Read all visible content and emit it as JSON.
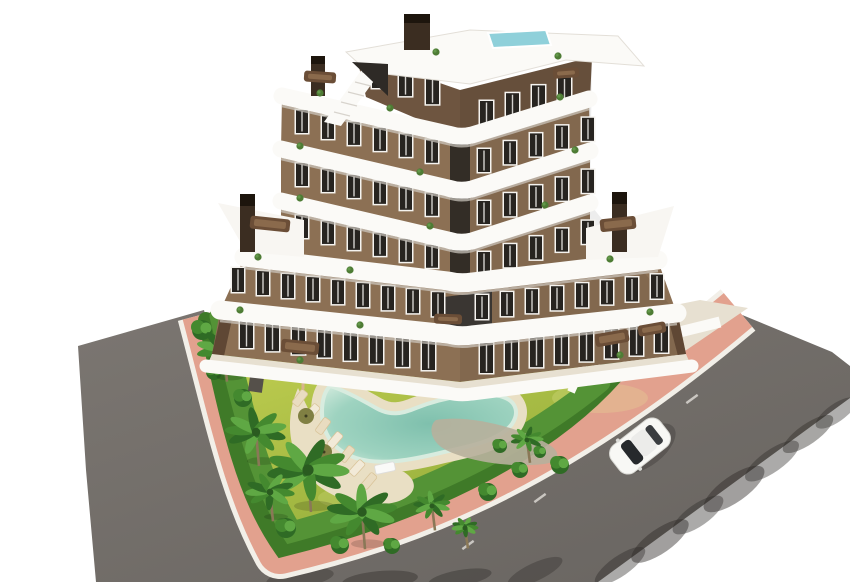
{
  "meta": {
    "scene_type": "aerial 3D architectural rendering",
    "subject": "modern apartment building with curved white balconies, pool garden, palm trees, corner plot with roads"
  },
  "colors": {
    "background": "#ffffff",
    "road": "#6f6a66",
    "road_light": "#7d7873",
    "sidewalk_pink": "#e2a18e",
    "curb_white": "#f2efe8",
    "lawn_light": "#c0cd4f",
    "lawn_dark": "#96af3c",
    "hedge_dark": "#3f7a28",
    "hedge_light": "#549336",
    "sand": "#e9dfc4",
    "gravel": "#b7b09c",
    "pool_deep": "#7fc0ad",
    "pool_shallow": "#cde8da",
    "facade": "#8c7054",
    "facade_dark": "#6e5540",
    "facade_side": "#5f4734",
    "band_white": "#fbfaf7",
    "band_shadow": "#cfcac2",
    "window_dark": "#272420",
    "window_frame": "#f5f3ef",
    "patio": "#e7e0d1",
    "chimney": "#3b2d21",
    "chimney_cap": "#1d150d",
    "roof_pool": "#8fd0da",
    "car_body": "#f8f8f5",
    "car_glass": "#26292c",
    "palm_dark": "#2f6b25",
    "palm_mid": "#44892f",
    "palm_light": "#5fa844",
    "trunk": "#8a7857",
    "furniture": "#6b4e37",
    "umbrella": "#7a7a3c",
    "courtyard_dark": "#3a3632"
  },
  "building": {
    "floors": 7,
    "window_rows": [
      {
        "x": 372,
        "y": 62,
        "slope": 0.3,
        "n": 3,
        "dx": 27,
        "w": 13,
        "h": 26
      },
      {
        "x": 480,
        "y": 101,
        "slope": -0.3,
        "n": 4,
        "dx": 26,
        "w": 13,
        "h": 26
      },
      {
        "x": 296,
        "y": 110,
        "slope": 0.229,
        "n": 6,
        "dx": 26,
        "w": 12,
        "h": 23
      },
      {
        "x": 478,
        "y": 149,
        "slope": -0.3,
        "n": 5,
        "dx": 26,
        "w": 12,
        "h": 23
      },
      {
        "x": 296,
        "y": 163,
        "slope": 0.229,
        "n": 6,
        "dx": 26,
        "w": 12,
        "h": 23
      },
      {
        "x": 478,
        "y": 201,
        "slope": -0.3,
        "n": 5,
        "dx": 26,
        "w": 12,
        "h": 23
      },
      {
        "x": 296,
        "y": 215,
        "slope": 0.229,
        "n": 6,
        "dx": 26,
        "w": 12,
        "h": 23
      },
      {
        "x": 478,
        "y": 252,
        "slope": -0.3,
        "n": 5,
        "dx": 26,
        "w": 12,
        "h": 23
      },
      {
        "x": 232,
        "y": 268,
        "slope": 0.121,
        "n": 9,
        "dx": 25,
        "w": 12,
        "h": 24
      },
      {
        "x": 476,
        "y": 295,
        "slope": -0.117,
        "n": 8,
        "dx": 25,
        "w": 12,
        "h": 24
      },
      {
        "x": 240,
        "y": 318,
        "slope": 0.121,
        "n": 8,
        "dx": 26,
        "w": 13,
        "h": 30
      },
      {
        "x": 480,
        "y": 343,
        "slope": -0.117,
        "n": 8,
        "dx": 25,
        "w": 13,
        "h": 30
      }
    ],
    "balcony_plants": [
      [
        320,
        93
      ],
      [
        390,
        108
      ],
      [
        560,
        97
      ],
      [
        300,
        146
      ],
      [
        420,
        172
      ],
      [
        575,
        150
      ],
      [
        300,
        198
      ],
      [
        430,
        226
      ],
      [
        545,
        205
      ],
      [
        258,
        257
      ],
      [
        350,
        270
      ],
      [
        610,
        259
      ],
      [
        240,
        310
      ],
      [
        360,
        325
      ],
      [
        650,
        312
      ],
      [
        300,
        360
      ],
      [
        620,
        355
      ],
      [
        436,
        52
      ],
      [
        558,
        56
      ]
    ],
    "furniture": [
      [
        270,
        224,
        40,
        13,
        6
      ],
      [
        618,
        224,
        36,
        13,
        -6
      ],
      [
        320,
        77,
        32,
        11,
        4
      ],
      [
        566,
        73,
        26,
        10,
        -4
      ],
      [
        300,
        347,
        38,
        13,
        6
      ],
      [
        612,
        338,
        34,
        13,
        -10
      ],
      [
        652,
        329,
        28,
        11,
        -10
      ],
      [
        448,
        319,
        28,
        10,
        2
      ]
    ]
  },
  "garden": {
    "palms": [
      {
        "x": 224,
        "y": 350,
        "r": 27
      },
      {
        "x": 256,
        "y": 432,
        "r": 30
      },
      {
        "x": 308,
        "y": 470,
        "r": 40
      },
      {
        "x": 362,
        "y": 512,
        "r": 34
      },
      {
        "x": 270,
        "y": 492,
        "r": 24
      },
      {
        "x": 416,
        "y": 302,
        "r": 44
      },
      {
        "x": 522,
        "y": 306,
        "r": 22
      },
      {
        "x": 527,
        "y": 440,
        "r": 16
      },
      {
        "x": 432,
        "y": 506,
        "r": 18
      },
      {
        "x": 465,
        "y": 528,
        "r": 13
      }
    ],
    "bushes": [
      [
        202,
        330,
        10
      ],
      [
        214,
        372,
        8
      ],
      [
        243,
        398,
        9
      ],
      [
        286,
        528,
        10
      ],
      [
        340,
        545,
        9
      ],
      [
        392,
        546,
        8
      ],
      [
        488,
        492,
        9
      ],
      [
        520,
        470,
        8
      ],
      [
        586,
        376,
        10
      ],
      [
        608,
        360,
        9
      ],
      [
        500,
        446,
        7
      ],
      [
        540,
        452,
        6
      ],
      [
        448,
        340,
        6
      ],
      [
        472,
        344,
        6
      ],
      [
        492,
        340,
        5
      ],
      [
        302,
        338,
        8
      ],
      [
        332,
        334,
        7
      ],
      [
        560,
        465,
        9
      ]
    ],
    "loungers": [
      [
        300,
        398,
        -52
      ],
      [
        312,
        412,
        -50
      ],
      [
        323,
        426,
        -54
      ],
      [
        335,
        440,
        -50
      ],
      [
        347,
        454,
        -52
      ],
      [
        357,
        468,
        -48
      ],
      [
        369,
        481,
        -50
      ]
    ],
    "bench_white": [
      385,
      468,
      -12
    ],
    "umbrellas": [
      [
        306,
        416
      ],
      [
        324,
        452
      ]
    ],
    "figures": [
      [
        303,
        386,
        "#d8b48e"
      ],
      [
        633,
        224,
        "#3aa0c8"
      ],
      [
        251,
        232,
        "#c06a50"
      ],
      [
        566,
        72,
        "#c8c0b4"
      ]
    ]
  },
  "road": {
    "dashes": [
      [
        692,
        399,
        -36
      ],
      [
        540,
        498,
        -36
      ],
      [
        468,
        545,
        -36
      ]
    ],
    "shadows": [
      [
        620,
        566,
        30,
        10,
        -35,
        0.4
      ],
      [
        660,
        541,
        34,
        12,
        -35,
        0.45
      ],
      [
        698,
        515,
        30,
        11,
        -35,
        0.4
      ],
      [
        734,
        489,
        36,
        13,
        -35,
        0.45
      ],
      [
        772,
        461,
        32,
        11,
        -35,
        0.4
      ],
      [
        808,
        434,
        30,
        10,
        -35,
        0.42
      ],
      [
        836,
        413,
        24,
        9,
        -35,
        0.38
      ],
      [
        300,
        578,
        34,
        9,
        -8,
        0.35
      ],
      [
        380,
        580,
        38,
        9,
        -5,
        0.4
      ],
      [
        460,
        578,
        32,
        8,
        -10,
        0.38
      ],
      [
        535,
        572,
        30,
        9,
        -25,
        0.35
      ]
    ],
    "car": {
      "x": 640,
      "y": 446,
      "angle": -38
    }
  }
}
